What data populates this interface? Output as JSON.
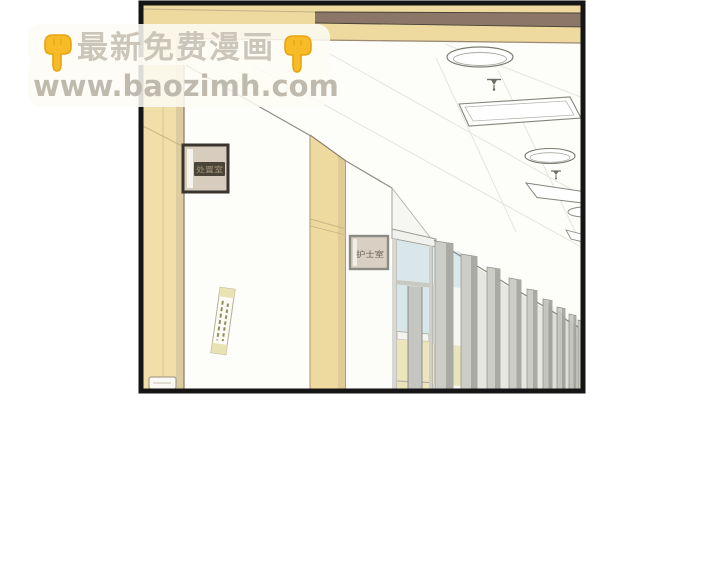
{
  "watermark": {
    "line1": "最新免费漫画",
    "line2": "www.baozimh.com"
  },
  "panel": {
    "door_sign_1": "处置室",
    "door_sign_2": "护士室"
  },
  "colors": {
    "finger_yellow": "#f7bb28",
    "finger_outline": "#e8a412",
    "watermark_band": "rgba(253,251,245,0.86)",
    "watermark_text": "#c7c1b5",
    "panel_border": "#151515",
    "wood": "#eeda9f",
    "wood_shadow": "#dccb9e",
    "beam_stripe": "#8b7668",
    "wall_white": "#fdfdf9",
    "glass_blue": "#d9e7ea",
    "glass_yellow": "#eae5bb",
    "slat_gray": "#cdcdc8",
    "slat_edge": "#aaaaa4",
    "sign_plate_dark": "#4b4439",
    "sign_frame_dark": "#3a342c"
  }
}
